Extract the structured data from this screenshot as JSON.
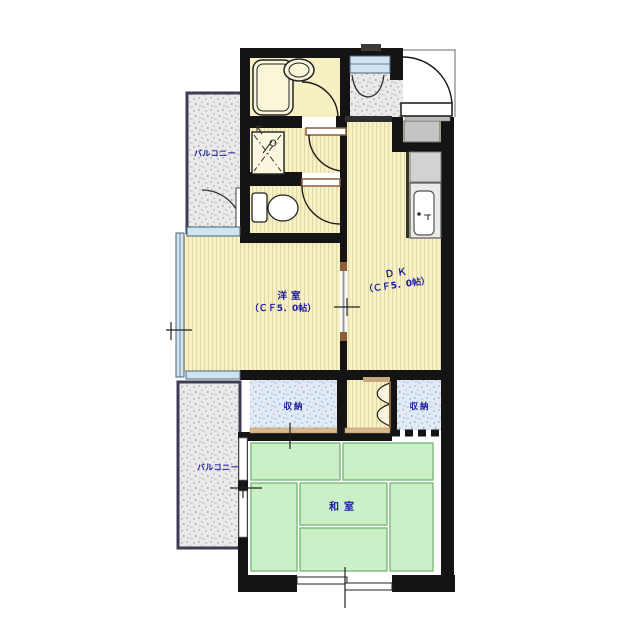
{
  "plan_title": "1DK+和室 マンション間取り図",
  "labels": {
    "balcony_upper": "バルコニー",
    "balcony_lower": "バルコニー",
    "western_room_name": "洋室",
    "western_room_size": "（ＣＦ5．0帖）",
    "dk_name": "ＤＫ",
    "dk_size": "（ＣＦ5．0帖）",
    "storage_left": "収納",
    "storage_right": "収納",
    "japanese_room": "和室"
  },
  "rooms": [
    {
      "name": "バルコニー（上）",
      "type": "balcony"
    },
    {
      "name": "浴室",
      "type": "bathroom"
    },
    {
      "name": "玄関",
      "type": "entrance"
    },
    {
      "name": "洗面・洗濯機置場",
      "type": "washroom"
    },
    {
      "name": "トイレ",
      "type": "toilet"
    },
    {
      "name": "ＤＫ（ＣＦ5．0帖）",
      "type": "dining-kitchen"
    },
    {
      "name": "洋室（ＣＦ5．0帖）",
      "type": "western-room"
    },
    {
      "name": "収納",
      "type": "storage"
    },
    {
      "name": "収納",
      "type": "storage"
    },
    {
      "name": "和室",
      "type": "japanese-room"
    },
    {
      "name": "バルコニー（下）",
      "type": "balcony"
    }
  ],
  "colors": {
    "wall": "#141414",
    "label": "#1A1A9C",
    "floor_stripe_base": "#F8F2C4",
    "floor_stripe_line": "#E2D9A8",
    "bathroom_floor": "#F6F0C2",
    "tatami": "#CBEFC7",
    "tatami_line": "#74B474",
    "storage_bg": "#E2EAF5",
    "balcony_bg": "#EAEAEA",
    "window_glass": "#CFE4F0",
    "door_frame": "#8B5E3C",
    "counter_gray": "#D2D2D2",
    "threshold": "#D8B88E"
  }
}
